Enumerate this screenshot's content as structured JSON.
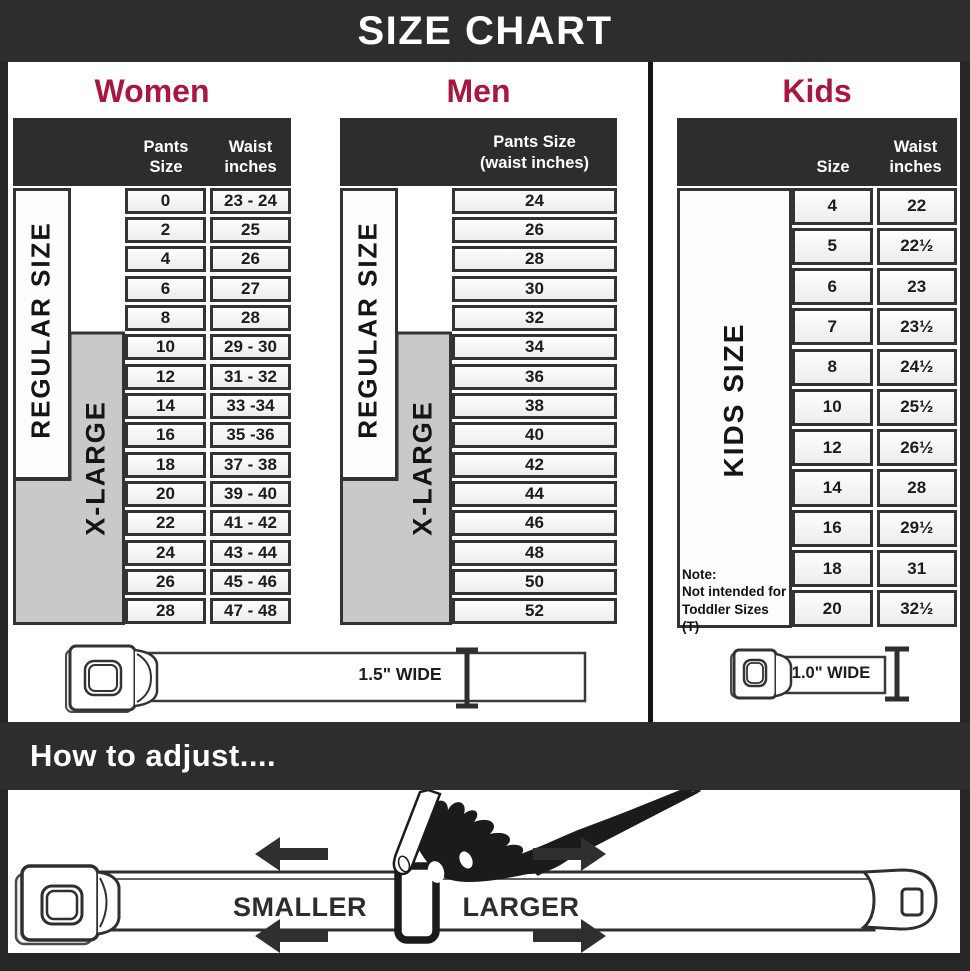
{
  "title": "SIZE CHART",
  "women": {
    "heading": "Women",
    "columns": [
      "Pants Size",
      "Waist inches"
    ],
    "regular_label": "REGULAR SIZE",
    "xlarge_label": "X-LARGE",
    "rows": [
      {
        "size": "0",
        "waist": "23 - 24"
      },
      {
        "size": "2",
        "waist": "25"
      },
      {
        "size": "4",
        "waist": "26"
      },
      {
        "size": "6",
        "waist": "27"
      },
      {
        "size": "8",
        "waist": "28"
      },
      {
        "size": "10",
        "waist": "29 - 30"
      },
      {
        "size": "12",
        "waist": "31 - 32"
      },
      {
        "size": "14",
        "waist": "33 -34"
      },
      {
        "size": "16",
        "waist": "35 -36"
      },
      {
        "size": "18",
        "waist": "37 - 38"
      },
      {
        "size": "20",
        "waist": "39 - 40"
      },
      {
        "size": "22",
        "waist": "41 - 42"
      },
      {
        "size": "24",
        "waist": "43 - 44"
      },
      {
        "size": "26",
        "waist": "45 - 46"
      },
      {
        "size": "28",
        "waist": "47 - 48"
      }
    ],
    "belt_width_label": "1.5\" WIDE"
  },
  "men": {
    "heading": "Men",
    "column_line1": "Pants Size",
    "column_line2": "(waist inches)",
    "regular_label": "REGULAR SIZE",
    "xlarge_label": "X-LARGE",
    "rows": [
      "24",
      "26",
      "28",
      "30",
      "32",
      "34",
      "36",
      "38",
      "40",
      "42",
      "44",
      "46",
      "48",
      "50",
      "52"
    ]
  },
  "kids": {
    "heading": "Kids",
    "columns": [
      "Size",
      "Waist inches"
    ],
    "label": "KIDS SIZE",
    "note_title": "Note:",
    "note_body": "Not intended for Toddler Sizes (T)",
    "rows": [
      {
        "size": "4",
        "waist": "22"
      },
      {
        "size": "5",
        "waist": "22½"
      },
      {
        "size": "6",
        "waist": "23"
      },
      {
        "size": "7",
        "waist": "23½"
      },
      {
        "size": "8",
        "waist": "24½"
      },
      {
        "size": "10",
        "waist": "25½"
      },
      {
        "size": "12",
        "waist": "26½"
      },
      {
        "size": "14",
        "waist": "28"
      },
      {
        "size": "16",
        "waist": "29½"
      },
      {
        "size": "18",
        "waist": "31"
      },
      {
        "size": "20",
        "waist": "32½"
      }
    ],
    "belt_width_label": "1.0\" WIDE"
  },
  "how_to": {
    "heading": "How to adjust....",
    "smaller_label": "SMALLER",
    "larger_label": "LARGER"
  },
  "colors": {
    "banner_bg": "#2d2d2d",
    "heading_red": "#a8173f",
    "table_border": "#333333",
    "xlarge_gray": "#c9c9c9"
  }
}
